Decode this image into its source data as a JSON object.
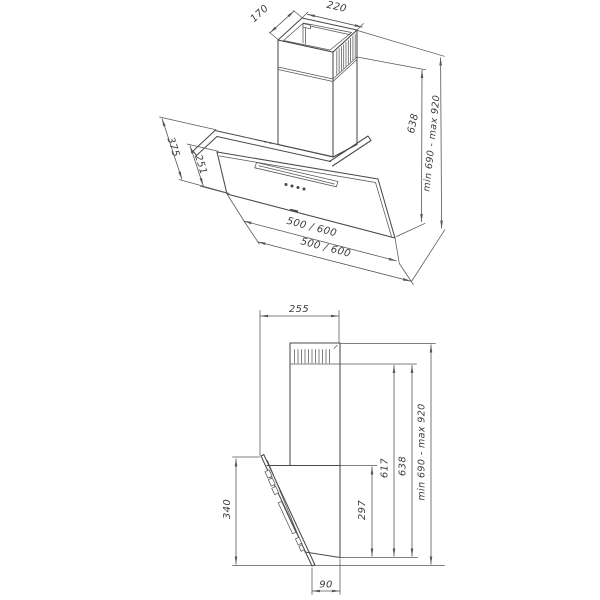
{
  "drawing": {
    "background": "#ffffff",
    "object_line_color": "#4a4a4a",
    "dimension_line_color": "#565656",
    "text_color": "#3d3d3d"
  },
  "perspective_view": {
    "dims": {
      "chimney_top_width": "220",
      "chimney_top_depth": "170",
      "panel_slant_depth": "375",
      "glass_top_depth": "251",
      "hood_width_upper": "500 / 600",
      "hood_width_lower": "500 / 600",
      "chimney_height": "638",
      "install_height_range": "min 690 - max 920"
    }
  },
  "side_view": {
    "dims": {
      "top_depth": "255",
      "front_glass_height": "340",
      "body_back_height": "297",
      "duct_height": "617",
      "chimney_height": "638",
      "install_height_range": "min 690 - max 920",
      "wall_offset_bottom": "90"
    }
  }
}
